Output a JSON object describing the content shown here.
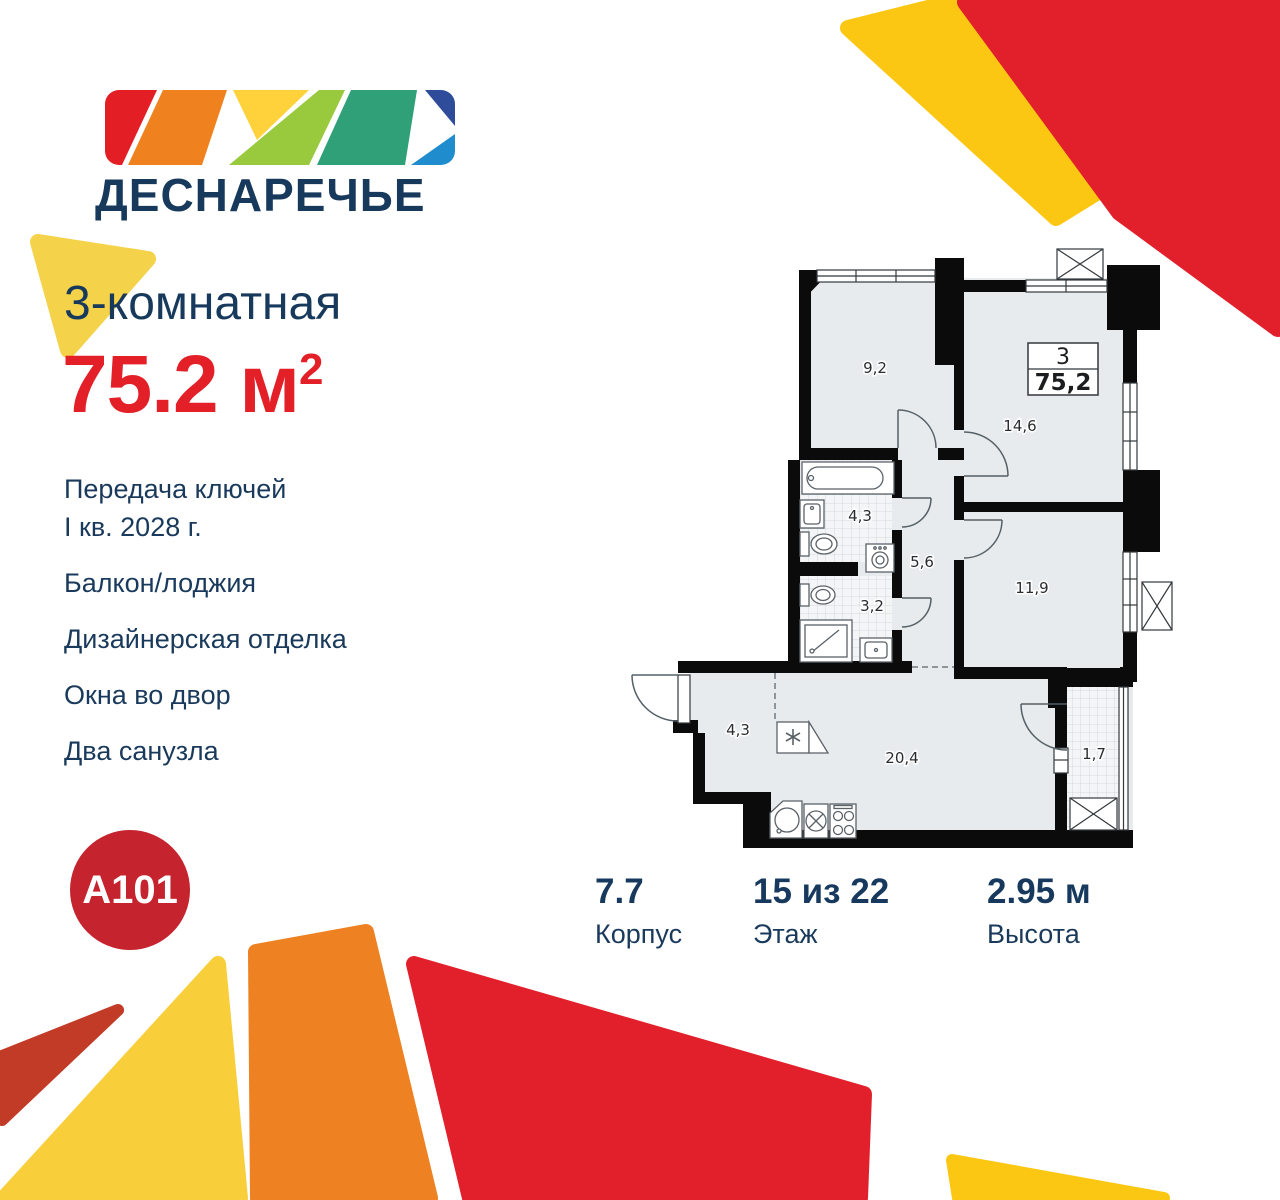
{
  "brand": {
    "logo_text": "ДЕСНАРЕЧЬЕ",
    "developer_logo": "A101"
  },
  "offer": {
    "title": "3-комнатная",
    "area_value": "75.2 м",
    "area_superscript": "2"
  },
  "features": [
    "Передача ключей\nI кв. 2028 г.",
    "Балкон/лоджия",
    "Дизайнерская отделка",
    "Окна во двор",
    "Два санузла"
  ],
  "floorplan": {
    "badge": {
      "rooms": "3",
      "area": "75,2"
    },
    "room_labels": {
      "bedroom_top_left": "9,2",
      "bedroom_top_right": "14,6",
      "bathroom": "4,3",
      "hallway": "5,6",
      "wc": "3,2",
      "bedroom_right": "11,9",
      "entry_hall": "4,3",
      "kitchen_living": "20,4",
      "loggia": "1,7"
    }
  },
  "stats": [
    {
      "value": "7.7",
      "label": "Корпус"
    },
    {
      "value": "15 из 22",
      "label": "Этаж"
    },
    {
      "value": "2.95 м",
      "label": "Высота"
    }
  ],
  "colors": {
    "navy": "#17395C",
    "accent_red": "#E31F28",
    "brand_circle_red": "#C5242F",
    "shape_yellow": "#FBC712",
    "shape_yellow_soft": "#F4D24A",
    "shape_orange": "#EE8122",
    "shape_red": "#E2202C",
    "shape_brick": "#C13B27",
    "plan_wall": "#0B0B0C",
    "plan_floor": "#E8EBEE"
  }
}
